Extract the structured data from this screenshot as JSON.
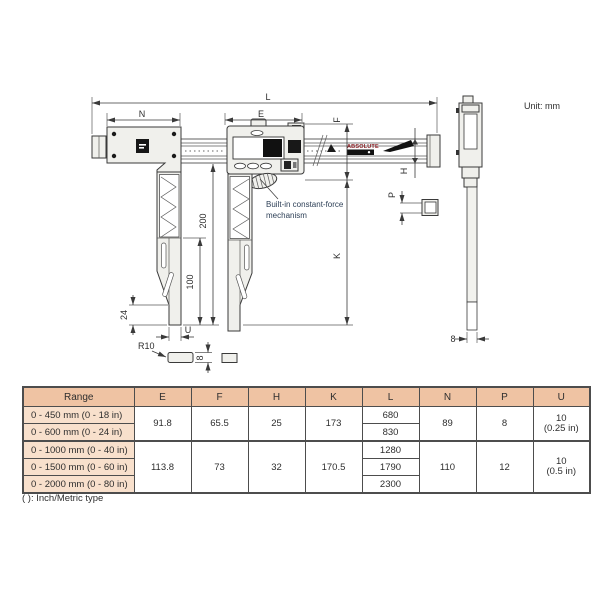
{
  "unit_label": "Unit: mm",
  "drawing": {
    "logo": "ABSOLUTE",
    "note_line1": "Built-in constant-force",
    "note_line2": "mechanism",
    "labels": {
      "L": "L",
      "N": "N",
      "E": "E",
      "F": "F",
      "H": "H",
      "P": "P",
      "K": "K",
      "U": "U",
      "len200": "200",
      "len100": "100",
      "len24": "24",
      "r10": "R10",
      "tip8": "8",
      "side8": "8"
    }
  },
  "table": {
    "headers": [
      "Range",
      "E",
      "F",
      "H",
      "K",
      "L",
      "N",
      "P",
      "U"
    ],
    "groups": [
      {
        "ranges": [
          "0 - 450 mm (0 - 18 in)",
          "0 - 600 mm (0 - 24 in)"
        ],
        "E": "91.8",
        "F": "65.5",
        "H": "25",
        "K": "173",
        "L": [
          "680",
          "830"
        ],
        "N": "89",
        "P": "8",
        "U": [
          "10",
          "(0.25 in)"
        ]
      },
      {
        "ranges": [
          "0 - 1000 mm (0 - 40 in)",
          "0 - 1500 mm (0 - 60 in)",
          "0 - 2000 mm (0 - 80 in)"
        ],
        "E": "113.8",
        "F": "73",
        "H": "32",
        "K": "170.5",
        "L": [
          "1280",
          "1790",
          "2300"
        ],
        "N": "110",
        "P": "12",
        "U": [
          "10",
          "(0.5 in)"
        ]
      }
    ],
    "footnote": "( ): Inch/Metric type"
  },
  "colors": {
    "table_header_bg": "#efc3a3",
    "table_range_bg": "#f8e0cc",
    "drawing_line": "#3a3a3a",
    "logo_red": "#8a1f24",
    "annotation_blue": "#2e4057"
  }
}
